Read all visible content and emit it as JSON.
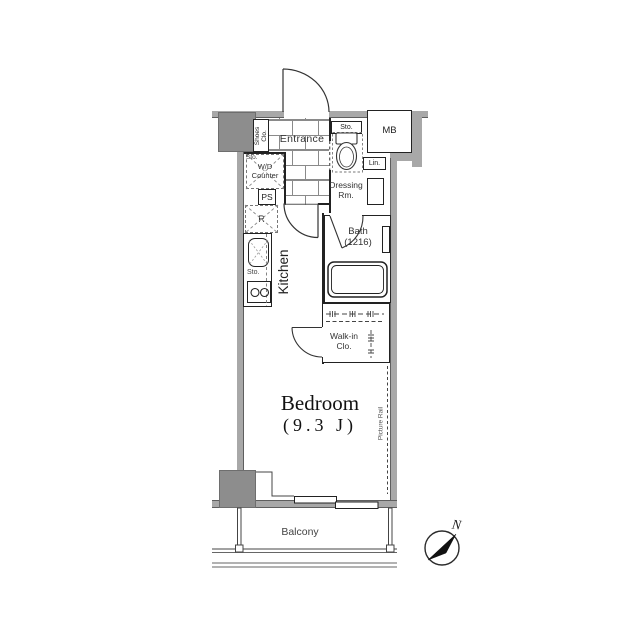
{
  "colors": {
    "wall": "#a8a8a8",
    "pillar": "#8d8d8d",
    "line": "#222222",
    "text": "#222222",
    "muted": "#555555"
  },
  "rooms": {
    "entrance": {
      "label": "Entrance"
    },
    "kitchen": {
      "label": "Kitchen"
    },
    "bath": {
      "label": "Bath",
      "size": "(1216)"
    },
    "dressing_room": {
      "line1": "Dressing",
      "line2": "Rm."
    },
    "walk_in_closet": {
      "line1": "Walk-in",
      "line2": "Clo."
    },
    "bedroom": {
      "label": "Bedroom",
      "size": "(9.3 J)"
    },
    "balcony": {
      "label": "Balcony"
    }
  },
  "fixtures": {
    "shoes_closet": {
      "line1": "Shoes",
      "line2": "Clo."
    },
    "storage_above_toilet": {
      "label": "Sto."
    },
    "storage_counter": {
      "label": "Sto."
    },
    "wd_counter": {
      "line1": "W/D",
      "line2": "Counter"
    },
    "pipe_space": {
      "label": "PS"
    },
    "refrigerator": {
      "label": "R"
    },
    "linen": {
      "label": "Lin."
    },
    "meter_box": {
      "label": "MB"
    },
    "storage_kitchen": {
      "label": "Sto."
    },
    "picture_rail": {
      "label": "Picture Rail"
    }
  },
  "compass": {
    "north_label": "N"
  }
}
